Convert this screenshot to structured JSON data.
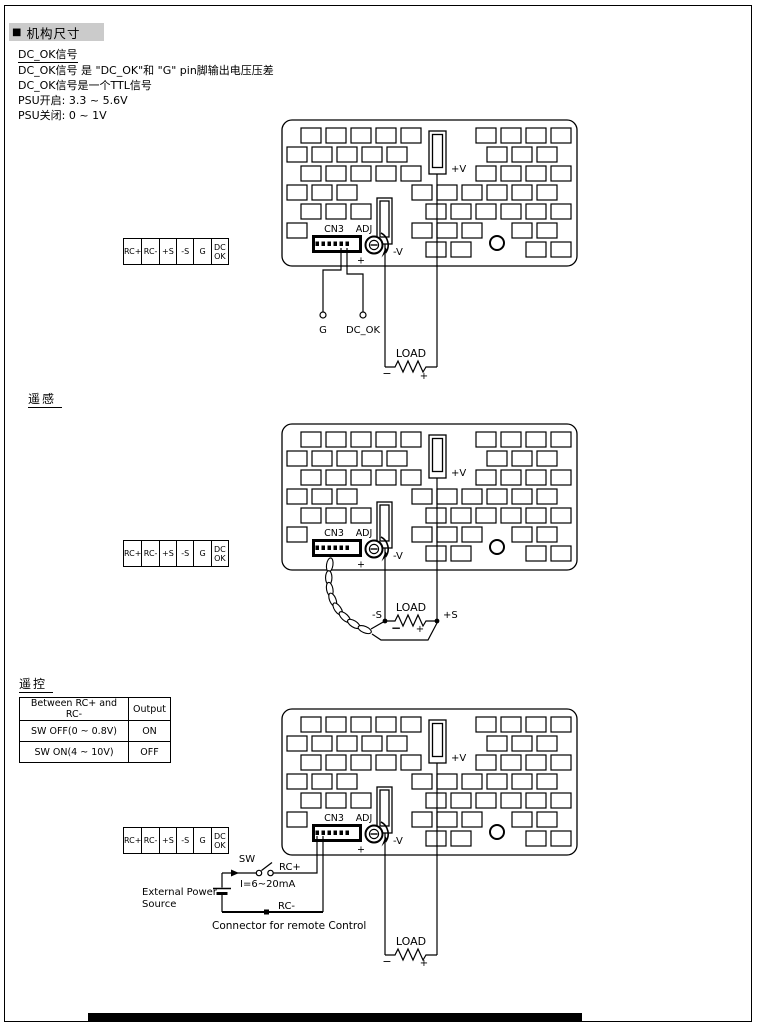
{
  "header": {
    "bullet": "■",
    "title": "机构尺寸"
  },
  "intro": {
    "line1": "DC_OK信号",
    "line2": "DC_OK信号 是 \"DC_OK\"和 \"G\" pin脚输出电压压差",
    "line3": "DC_OK信号是一个TTL信号",
    "line4": "PSU开启: 3.3 ~ 5.6V",
    "line5": "PSU关闭: 0 ~ 1V"
  },
  "sections": {
    "remote_sense_title": "遥感",
    "remote_control_title": "遥控"
  },
  "terminal_block": {
    "cells": [
      "RC+",
      "RC-",
      "+S",
      "-S",
      "G",
      "DC OK"
    ]
  },
  "board_labels": {
    "cn3": "CN3",
    "adj": "ADJ",
    "plus_v": "+V",
    "minus_v": "-V",
    "adj_plus": "+"
  },
  "diagram1": {
    "g_label": "G",
    "dc_ok_label": "DC_OK",
    "load": "LOAD",
    "minus": "−",
    "plus": "+"
  },
  "diagram2": {
    "minus_s": "-S",
    "plus_s": "+S",
    "load": "LOAD",
    "minus": "−",
    "plus": "+"
  },
  "diagram3": {
    "sw": "SW",
    "rc_plus": "RC+",
    "current": "I=6~20mA",
    "ext_power_1": "External Power",
    "ext_power_2": "Source",
    "rc_minus": "RC-",
    "connector_note": "Connector for remote Control",
    "load": "LOAD",
    "minus": "−",
    "plus": "+"
  },
  "table": {
    "headers": [
      "Between RC+ and RC-",
      "Output"
    ],
    "rows": [
      [
        "SW OFF(0 ~ 0.8V)",
        "ON"
      ],
      [
        "SW ON(4 ~ 10V)",
        "OFF"
      ]
    ]
  }
}
